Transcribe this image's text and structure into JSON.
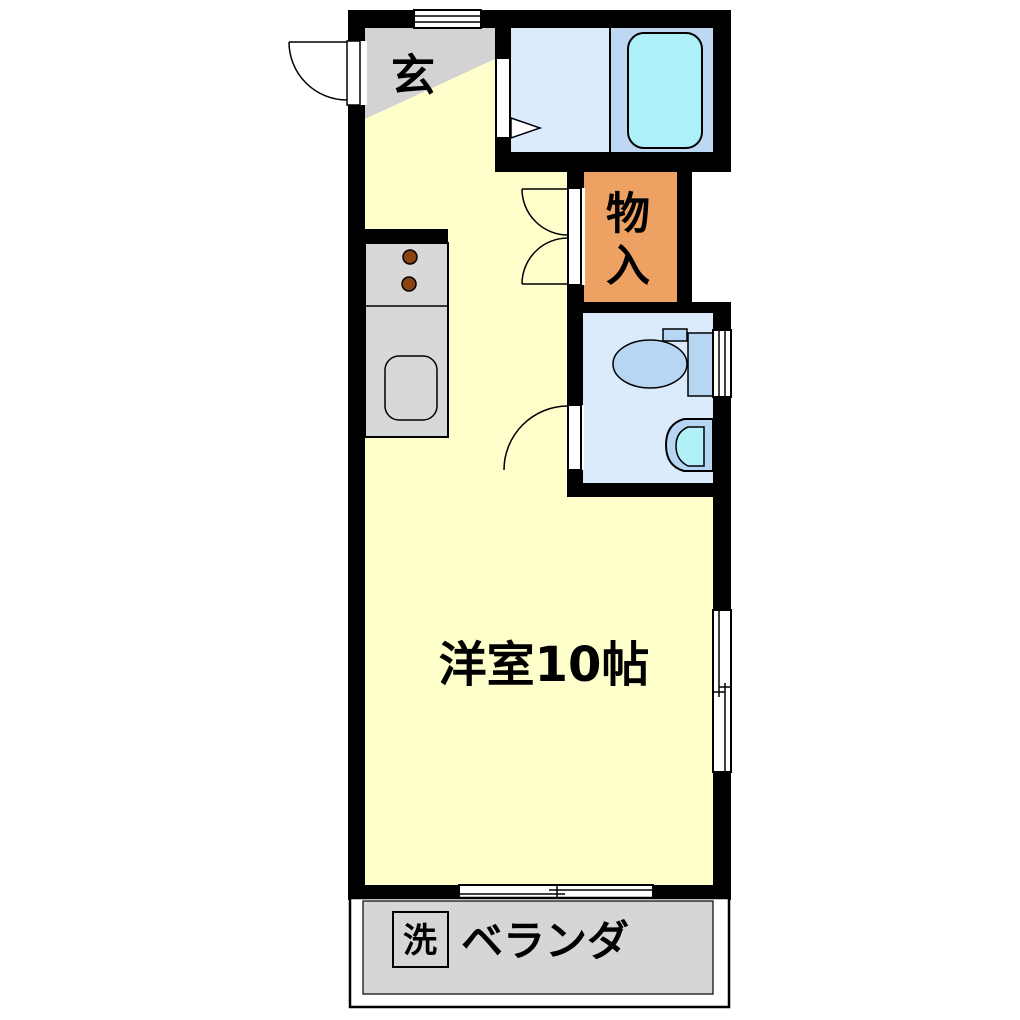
{
  "plan": {
    "type": "apartment-floor-plan",
    "rooms": {
      "genkan": {
        "label": "玄"
      },
      "closet": {
        "label": "物入",
        "chars": [
          "物",
          "入"
        ]
      },
      "living": {
        "label": "洋室10帖",
        "size_tatami": "10帖"
      },
      "veranda": {
        "label": "ベランダ"
      },
      "washer": {
        "label": "洗"
      }
    }
  },
  "colors": {
    "wall": "#000000",
    "white": "#ffffff",
    "floor_yellow": "#ffffcb",
    "genkan_gray": "#d3d3d3",
    "counter_gray": "#d8d8d8",
    "veranda_gray": "#d6d6d6",
    "closet_orange": "#eda263",
    "bath_floor_left": "#dcebfb",
    "bath_floor_right": "#bed8f3",
    "tub_cyan": "#adf0fa",
    "fixture_blue": "#b7d6f3",
    "basin_cyan": "#b2f0f8",
    "burner_brown": "#8a4412"
  }
}
